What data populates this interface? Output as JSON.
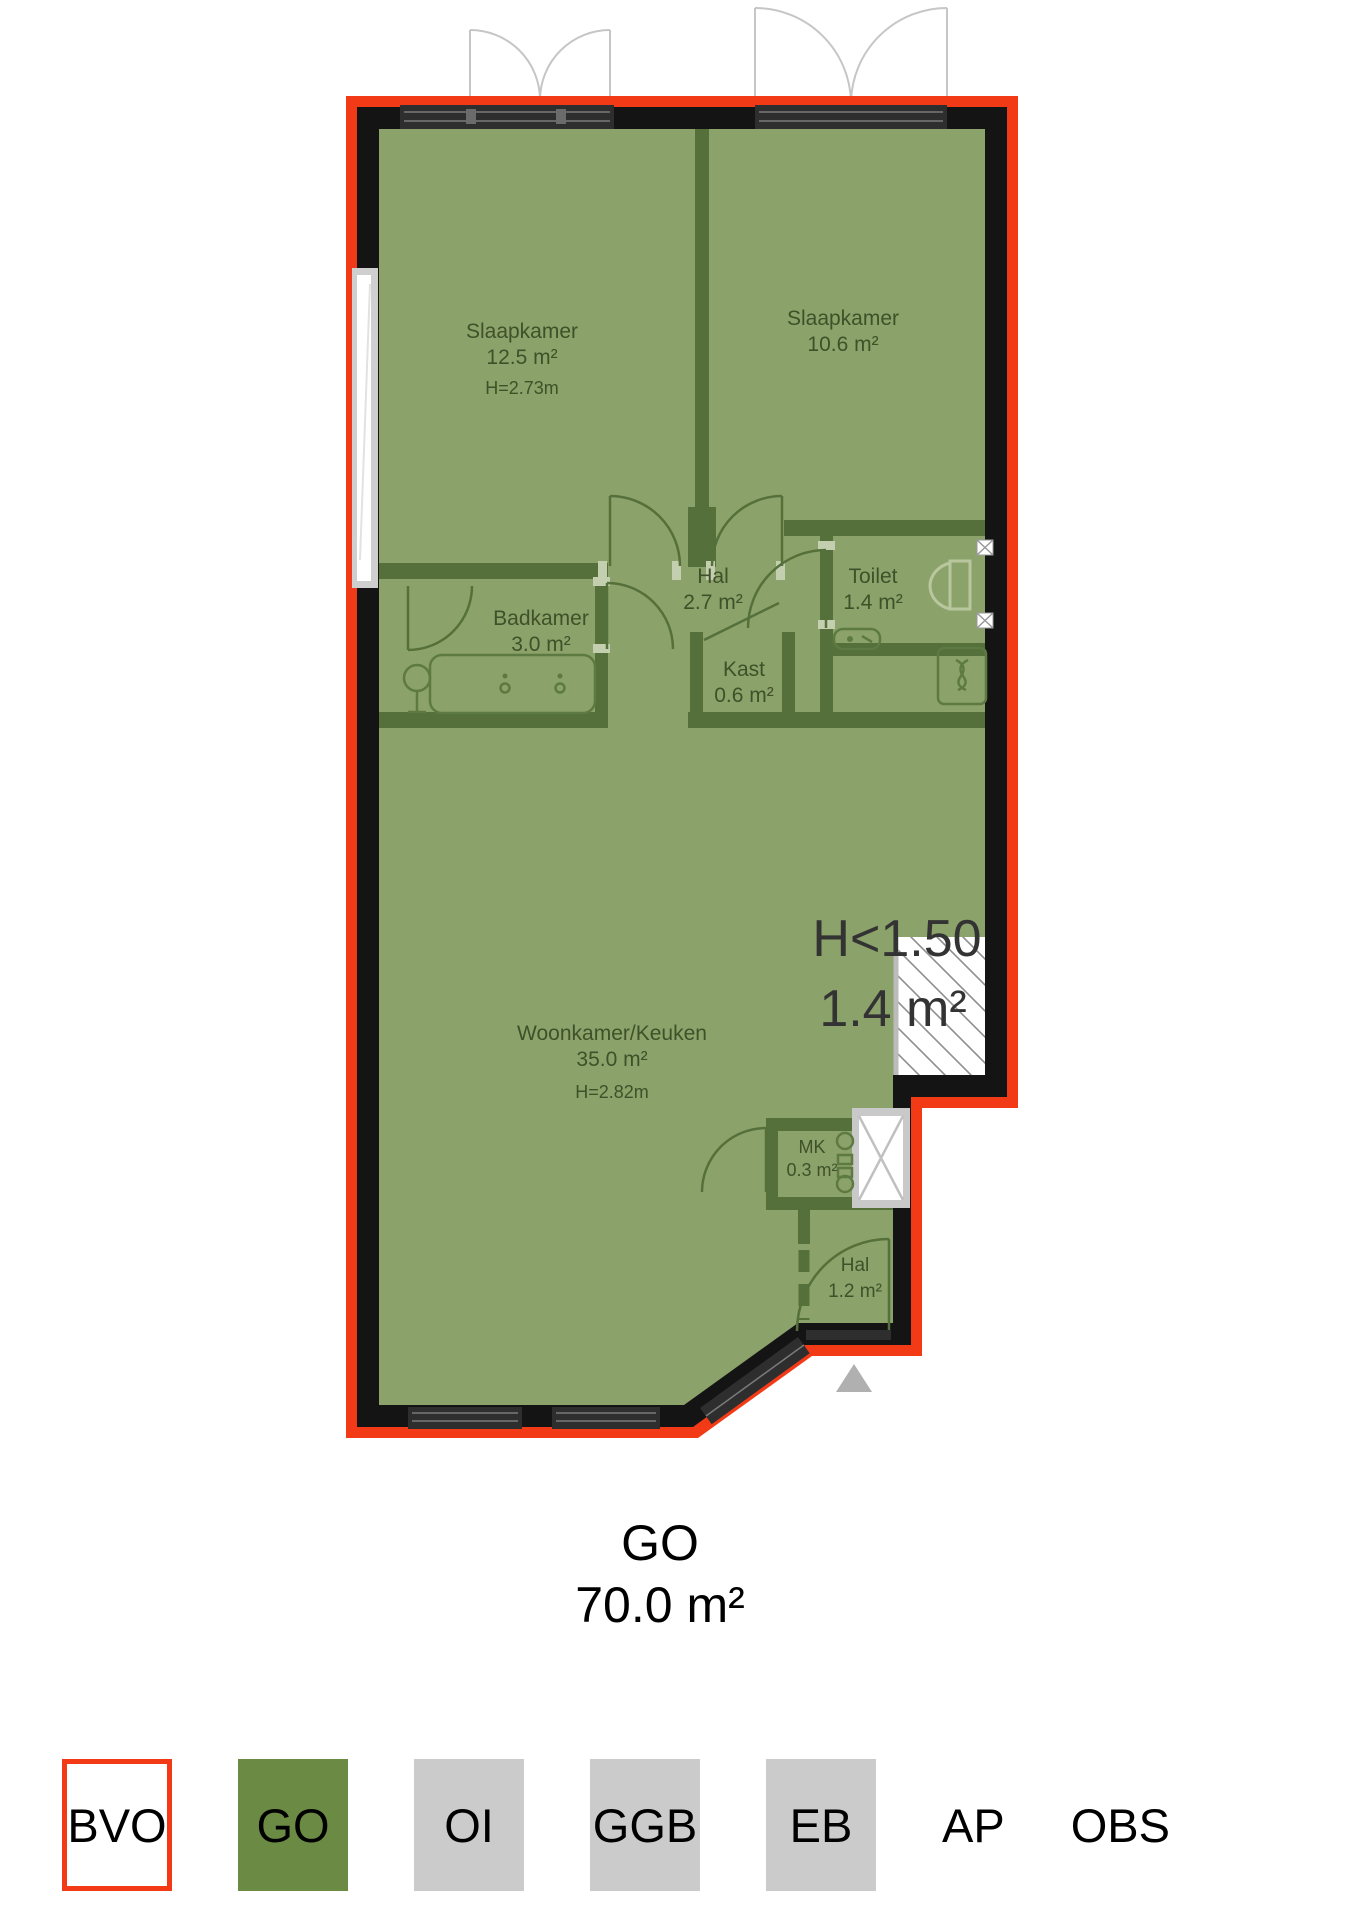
{
  "title": {
    "label": "GO",
    "area": "70.0 m²"
  },
  "plan": {
    "rooms": {
      "slaapkamer_links": {
        "name": "Slaapkamer",
        "area": "12.5 m²",
        "height": "H=2.73m"
      },
      "slaapkamer_rechts": {
        "name": "Slaapkamer",
        "area": "10.6 m²"
      },
      "hal": {
        "name": "Hal",
        "area": "2.7 m²"
      },
      "toilet": {
        "name": "Toilet",
        "area": "1.4 m²"
      },
      "badkamer": {
        "name": "Badkamer",
        "area": "3.0 m²"
      },
      "kast": {
        "name": "Kast",
        "area": "0.6 m²"
      },
      "woonkamer_keuken": {
        "name": "Woonkamer/Keuken",
        "area": "35.0 m²",
        "height": "H=2.82m"
      },
      "mk": {
        "name": "MK",
        "area": "0.3 m²"
      },
      "hal_entree": {
        "name": "Hal",
        "area": "1.2 m²"
      }
    },
    "low_headroom": {
      "label": "H<1.50",
      "area": "1.4 m²"
    }
  },
  "legend": {
    "bvo": "BVO",
    "go": "GO",
    "oi": "OI",
    "ggb": "GGB",
    "eb": "EB",
    "ap": "AP",
    "obs": "OBS"
  },
  "colors": {
    "bvo-red": "#F23B16",
    "go-green": "#6B8A44",
    "legend-gray": "#CBCBCB",
    "floor-green": "#8CA26B",
    "wall-green": "#55703A",
    "wall-black": "#141414",
    "label-green": "#3E5128",
    "headroom-text": "#333333"
  }
}
